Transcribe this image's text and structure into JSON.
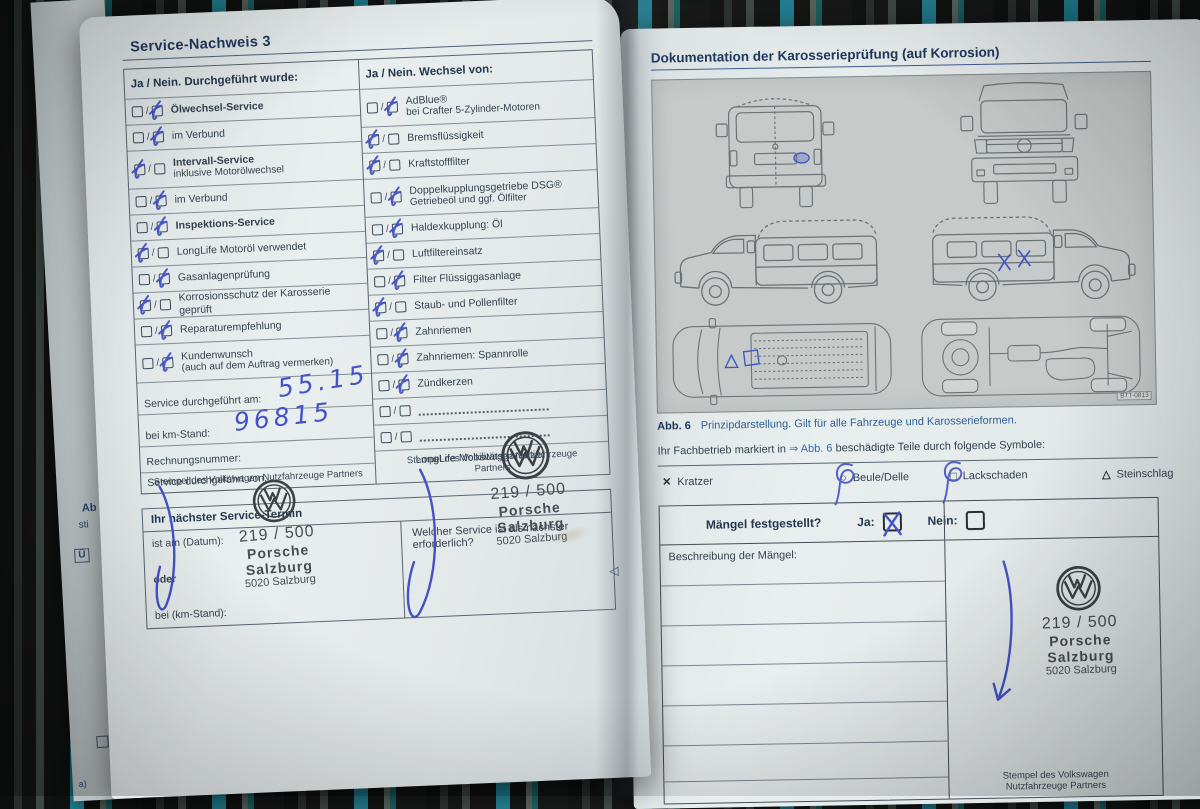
{
  "colors": {
    "accent_handwriting": "#4353c6",
    "title_blue": "#20385e",
    "text": "#35424f",
    "stamp_gray": "#474d53",
    "page": "#e6ebeb",
    "panel_gray": "#c6cbca",
    "fabric_teal": "#1f7f93"
  },
  "left_page": {
    "title": "Service-Nachweis 3",
    "table": {
      "col1_header": "Ja / Nein. Durchgeführt wurde:",
      "col2_header": "Ja / Nein. Wechsel von:",
      "col1_items": [
        {
          "label": "Ölwechsel-Service",
          "bold": true,
          "check": "second"
        },
        {
          "label": "im Verbund",
          "check": "second"
        },
        {
          "label": "Intervall-Service",
          "label2": "inklusive Motorölwechsel",
          "bold": true,
          "check": "first"
        },
        {
          "label": "im Verbund",
          "check": "second"
        },
        {
          "label": "Inspektions-Service",
          "bold": true,
          "check": "second"
        },
        {
          "label": "LongLife Motoröl verwendet",
          "check": "first"
        },
        {
          "label": "Gasanlagenprüfung",
          "check": "second"
        },
        {
          "label": "Korrosionsschutz der Karosserie geprüft",
          "check": "first"
        },
        {
          "label": "Reparaturempfehlung",
          "check": "second"
        },
        {
          "label": "Kundenwunsch",
          "label2": "(auch auf dem Auftrag vermerken)",
          "check": "second"
        }
      ],
      "col2_items": [
        {
          "label": "AdBlue®",
          "label2": "bei Crafter 5-Zylinder-Motoren",
          "check": "second"
        },
        {
          "label": "Bremsflüssigkeit",
          "check": "first"
        },
        {
          "label": "Kraftstofffilter",
          "check": "first"
        },
        {
          "label": "Doppelkupplungsgetriebe DSG®",
          "label2": "Getriebeöl und ggf. Ölfilter",
          "check": "second"
        },
        {
          "label": "Haldexkupplung: Öl",
          "check": "second"
        },
        {
          "label": "Luftfiltereinsatz",
          "check": "first"
        },
        {
          "label": "Filter Flüssiggasanlage",
          "check": "second"
        },
        {
          "label": "Staub- und Pollenfilter",
          "check": "first"
        },
        {
          "label": "Zahnriemen",
          "check": "second"
        },
        {
          "label": "Zahnriemen: Spannrolle",
          "check": "second"
        },
        {
          "label": "Zündkerzen",
          "check": "second"
        },
        {
          "dotted": true
        },
        {
          "dotted": true
        }
      ]
    },
    "fields": {
      "date_label": "Service durchgeführt am:",
      "date_value": "55.15",
      "km_label": "bei km-Stand:",
      "km_value": "96815",
      "invoice_label": "Rechnungsnummer:",
      "performed_by_label": "Service durchgeführt von:",
      "longlife_label": "LongLife Mobilitätsgarantie:"
    },
    "next_service": {
      "header": "Ihr nächster Service-Termin",
      "date_label": "ist am (Datum):",
      "or_label": "oder",
      "km_label": "bei (km-Stand):",
      "question": "Welcher Service ist als nächster erforderlich?"
    },
    "nav_glyph": "◁",
    "edge_fragments": {
      "f1": "Ab",
      "f2": "sti",
      "f3": "Ü",
      "f4": "a)"
    }
  },
  "stamp": {
    "number": "219 / 500",
    "dealer_line1": "Porsche",
    "dealer_line2": "Salzburg",
    "dealer_line3": "5020 Salzburg",
    "caption": "Stempel des Volkswagen Nutzfahrzeuge Partners"
  },
  "right_page": {
    "title": "Dokumentation der Karosserieprüfung (auf Korrosion)",
    "figure_code": "BTT-0813",
    "caption_label": "Abb. 6",
    "caption_text": "Prinzipdarstellung. Gilt für alle Fahrzeuge und Karosserieformen.",
    "intro_pre": "Ihr Fachbetrieb markiert in ",
    "intro_link": "⇒ Abb. 6",
    "intro_post": " beschädigte Teile durch folgende Symbole:",
    "symbols": [
      {
        "glyph": "✕",
        "label": "Kratzer"
      },
      {
        "glyph": "○",
        "label": "Beule/Delle"
      },
      {
        "glyph": "□",
        "label": "Lackschaden"
      },
      {
        "glyph": "△",
        "label": "Steinschlag"
      }
    ],
    "defects": {
      "question": "Mängel festgestellt?",
      "yes_label": "Ja:",
      "no_label": "Nein:",
      "yes_checked": true,
      "description_label": "Beschreibung der Mängel:"
    }
  }
}
